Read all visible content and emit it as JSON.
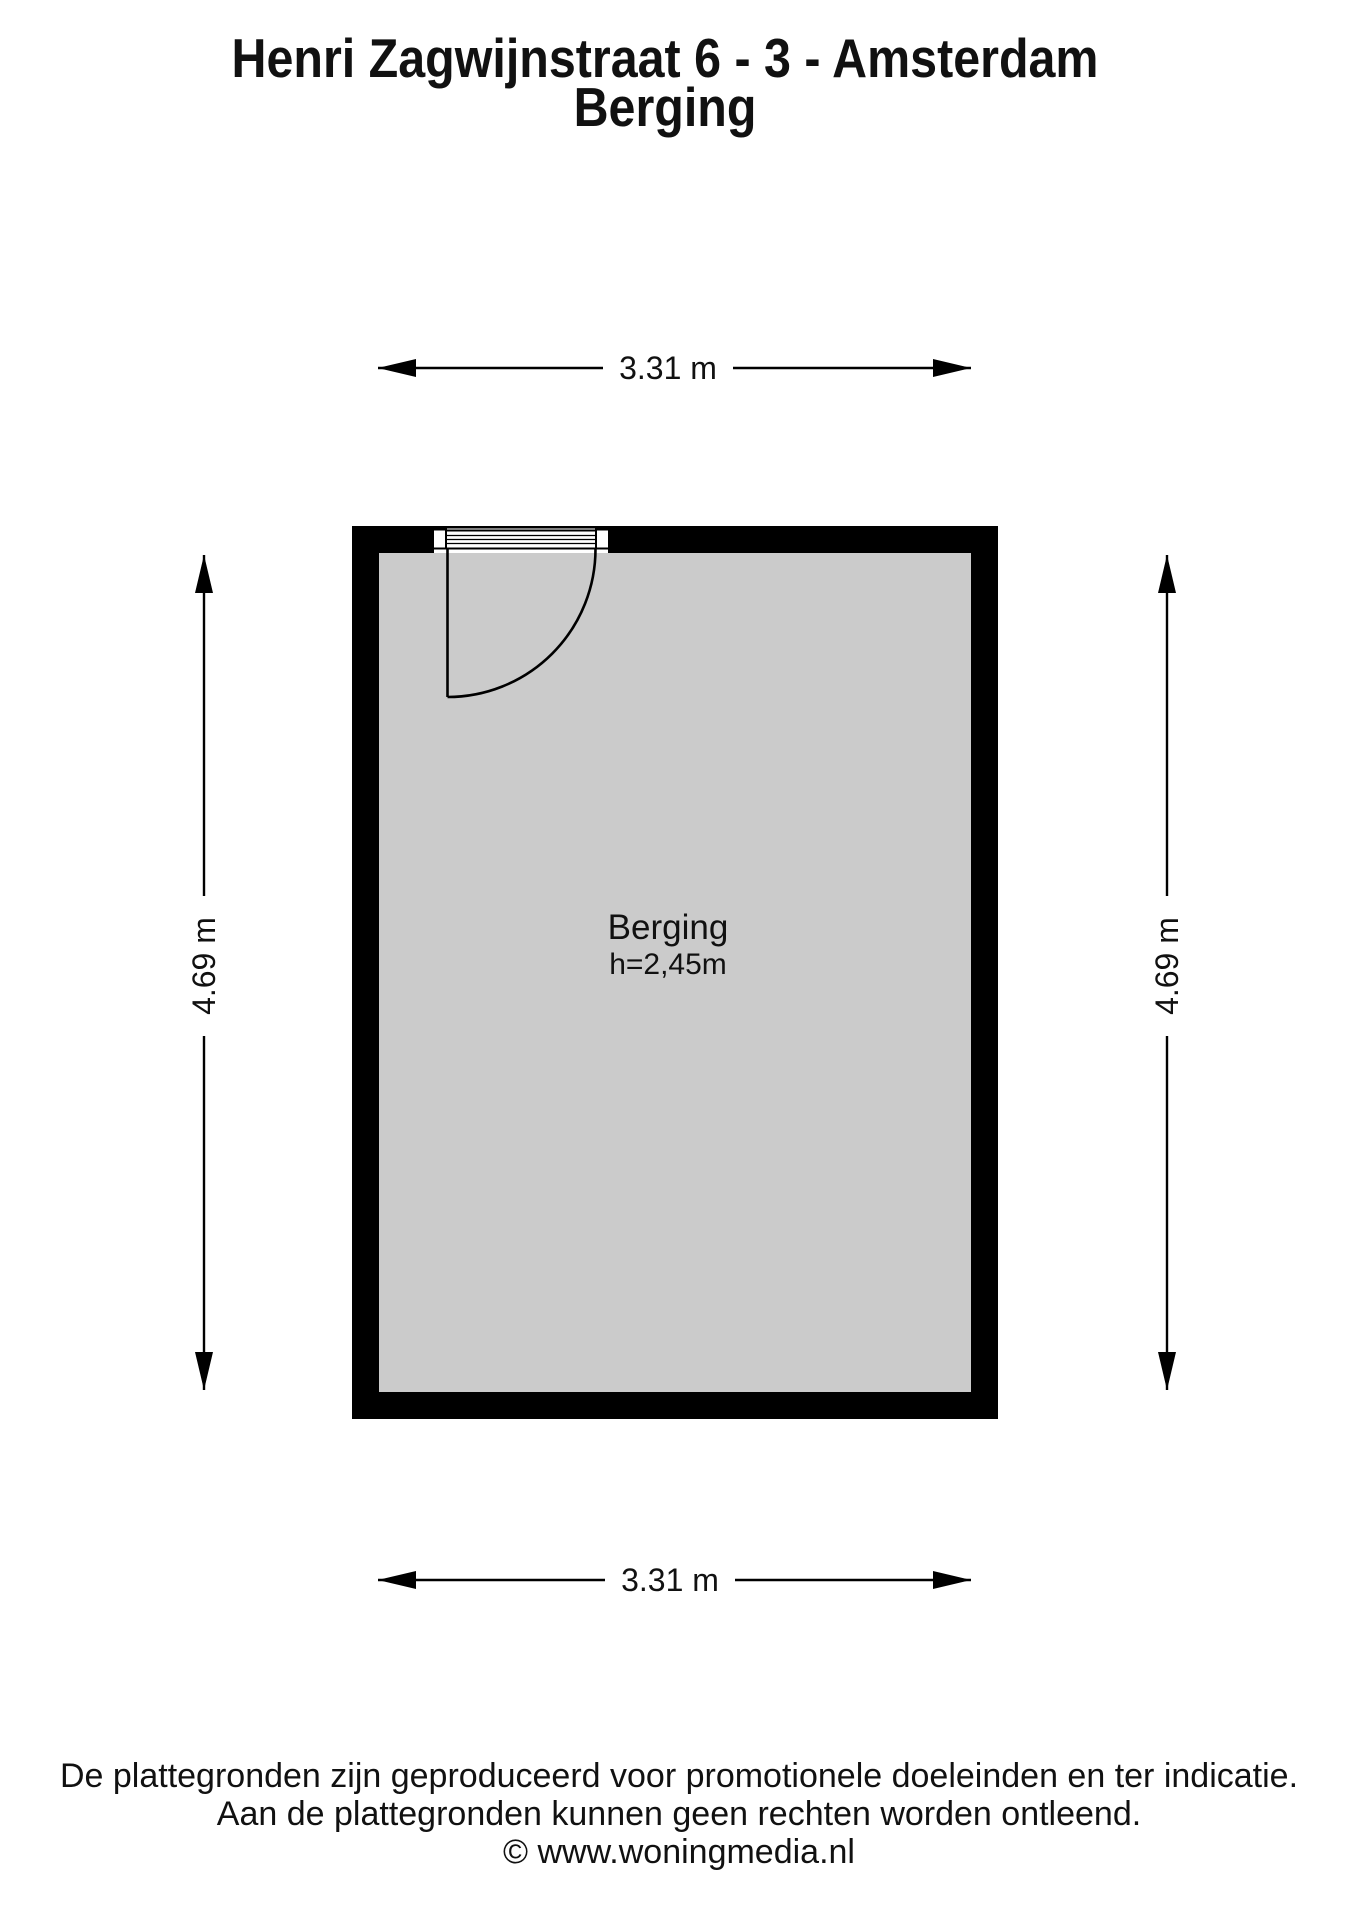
{
  "header": {
    "address": "Henri Zagwijnstraat 6 - 3 - Amsterdam",
    "subtitle": "Berging"
  },
  "floorplan": {
    "room": {
      "name": "Berging",
      "ceiling_height": "h=2,45m"
    },
    "dimensions": {
      "top": "3.31 m",
      "bottom": "3.31 m",
      "left": "4.69 m",
      "right": "4.69 m"
    },
    "colors": {
      "wall": "#000000",
      "floor": "#cbcbcb",
      "line": "#000000"
    }
  },
  "footer": {
    "disclaimer_line1": "De plattegronden zijn geproduceerd voor promotionele doeleinden en ter indicatie.",
    "disclaimer_line2": "Aan de plattegronden kunnen geen rechten worden ontleend.",
    "credit": "© www.woningmedia.nl"
  }
}
